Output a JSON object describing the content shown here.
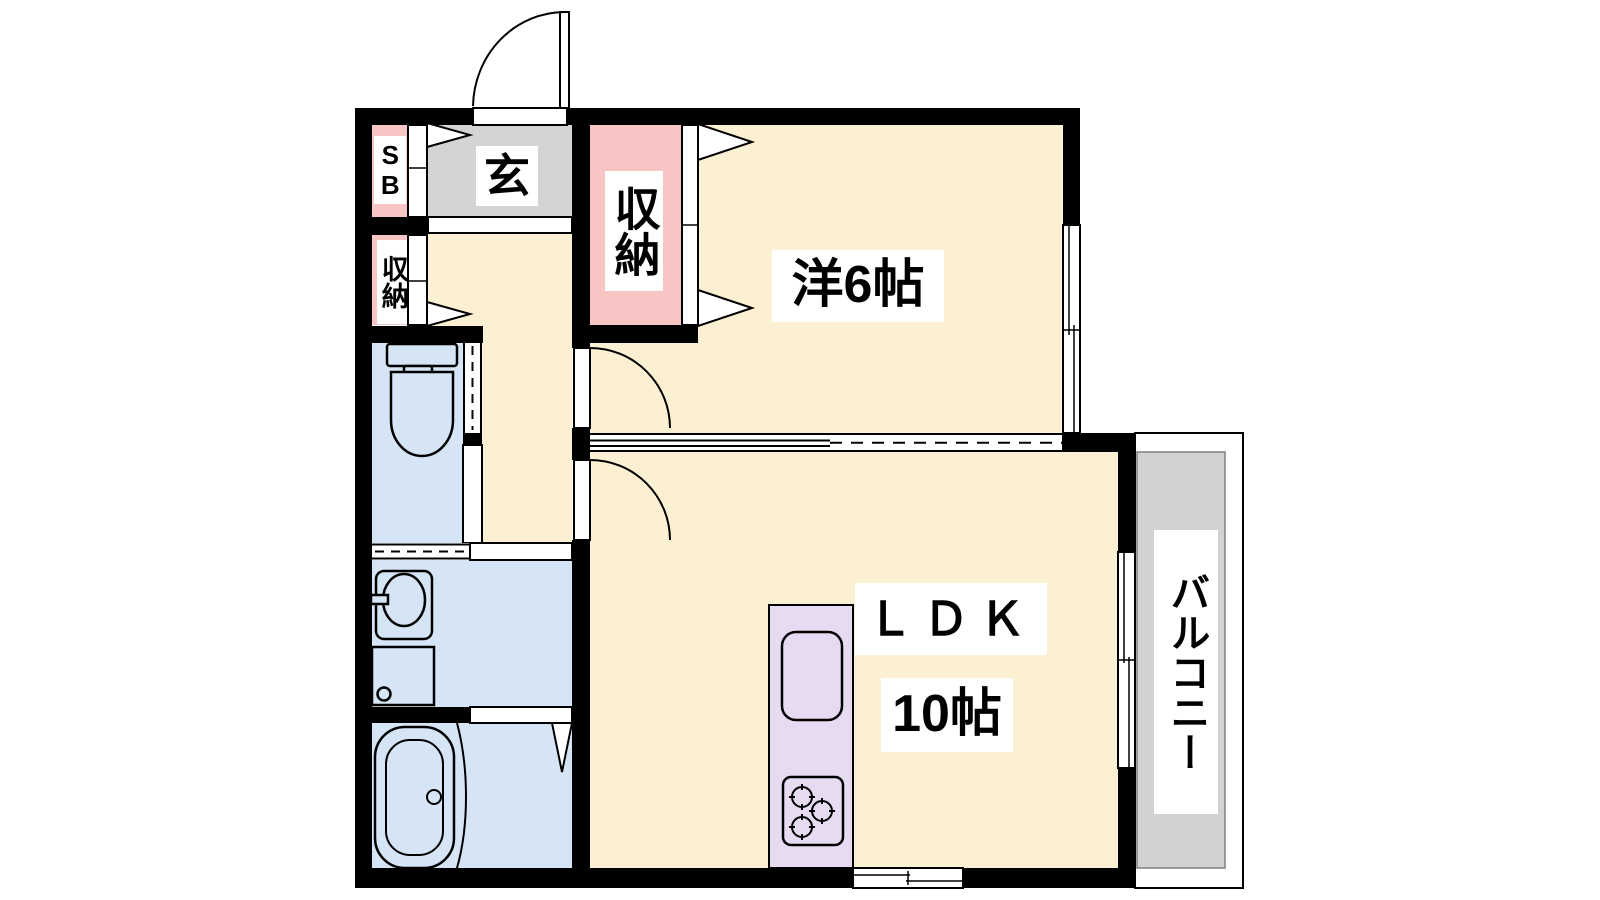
{
  "colors": {
    "wall": "#000000",
    "room": "#FBF0D1",
    "closet": "#F8C5C5",
    "entry": "#D4D4D4",
    "balcony": "#D2D2D2",
    "wet": "#D6E5F6",
    "kitchen": "#E6DBF1",
    "label_bg": "#FFFFFF",
    "text": "#000000"
  },
  "labels": {
    "shoe_box": "SB",
    "entrance": "玄",
    "storage_hall": "収納",
    "storage_room": "収納",
    "western_room": "洋6帖",
    "ldk": "ＬＤＫ",
    "ldk_size": "10帖",
    "balcony": "バルコニー"
  }
}
